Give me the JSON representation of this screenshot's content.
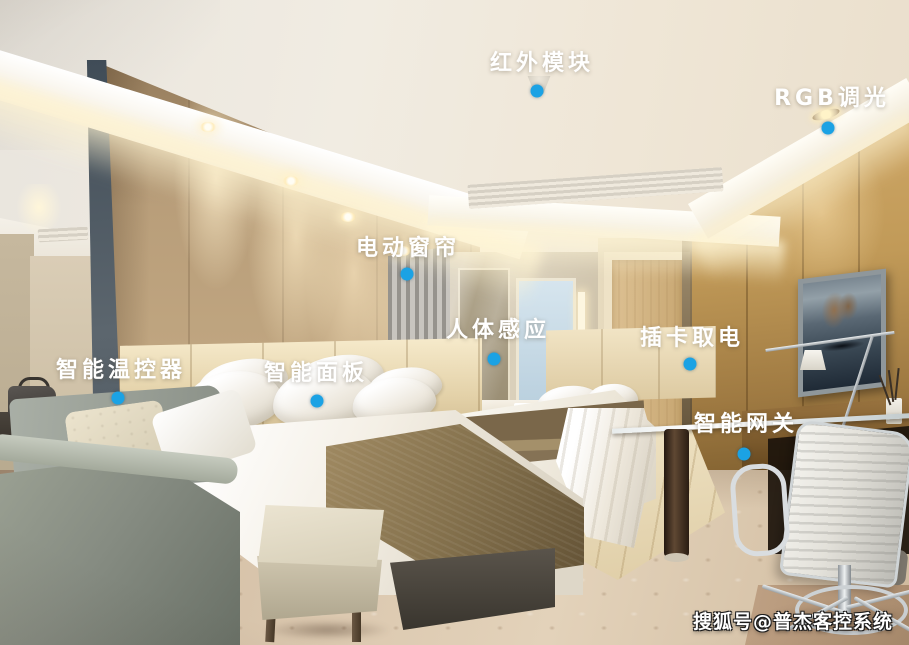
{
  "annotations": {
    "marker_color": "#1ba2e4",
    "label_color": "#ffffff",
    "labels": [
      {
        "id": "infrared-module",
        "text": "红外模块",
        "text_x": 542,
        "text_y": 61,
        "dot_x": 537,
        "dot_y": 91
      },
      {
        "id": "rgb-dimming",
        "text": "RGB调光",
        "text_x": 832,
        "text_y": 96,
        "dot_x": 828,
        "dot_y": 128
      },
      {
        "id": "motor-curtain",
        "text": "电动窗帘",
        "text_x": 408,
        "text_y": 246,
        "dot_x": 407,
        "dot_y": 274
      },
      {
        "id": "body-sensor",
        "text": "人体感应",
        "text_x": 498,
        "text_y": 328,
        "dot_x": 494,
        "dot_y": 359
      },
      {
        "id": "card-power",
        "text": "插卡取电",
        "text_x": 692,
        "text_y": 336,
        "dot_x": 690,
        "dot_y": 364
      },
      {
        "id": "smart-thermostat",
        "text": "智能温控器",
        "text_x": 121,
        "text_y": 368,
        "dot_x": 118,
        "dot_y": 398
      },
      {
        "id": "smart-panel",
        "text": "智能面板",
        "text_x": 316,
        "text_y": 371,
        "dot_x": 317,
        "dot_y": 401
      },
      {
        "id": "smart-gateway",
        "text": "智能网关",
        "text_x": 746,
        "text_y": 422,
        "dot_x": 744,
        "dot_y": 454
      }
    ]
  },
  "watermark": {
    "text": "搜狐号@普杰客控系统"
  }
}
